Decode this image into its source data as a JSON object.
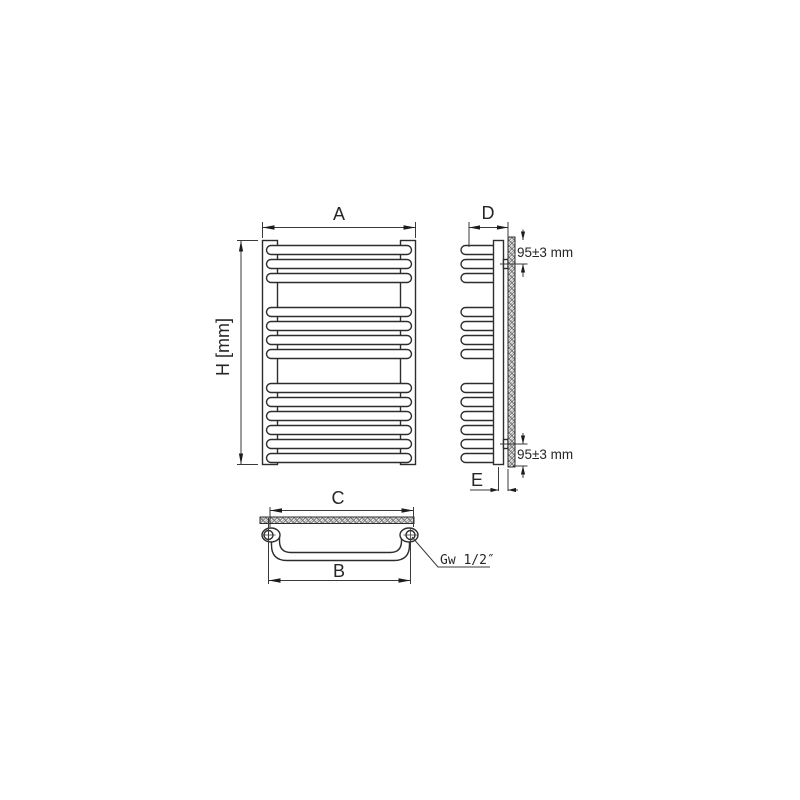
{
  "page": {
    "background": "#ffffff"
  },
  "drawing": {
    "labels": {
      "width": "A",
      "height": "H [mm]",
      "depth": "D",
      "wall_distance": "E",
      "upper_span": "C",
      "lower_span": "B",
      "offset_top": "95±3 mm",
      "offset_bottom": "95±3 mm",
      "thread": "Gw 1/2″"
    },
    "radiator": {
      "tube_groups": [
        3,
        4,
        6
      ],
      "tube_count": 13,
      "connection_count": 2
    },
    "colors": {
      "object_line": "#2d2d2d",
      "dimension_line": "#3a3a3a",
      "arrow_fill": "#1c1c1c",
      "hatch_line": "#6a6a6a",
      "hatch_background": "#efefef"
    }
  }
}
